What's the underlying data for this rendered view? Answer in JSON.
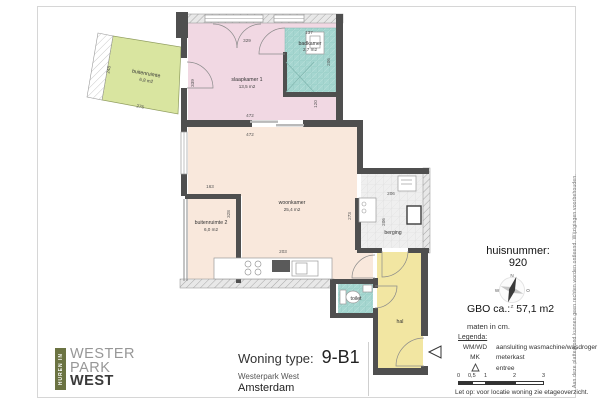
{
  "colors": {
    "wall": "#4f4f4f",
    "exterior_wall": "#e8e8e8",
    "slaapkamer_pink": "#f1d8e3",
    "woonkamer_cream": "#f9e8dc",
    "buitenruimte_green": "#d9e5a0",
    "sanitair_teal": "#a5d6d0",
    "hal_yellow": "#f2e6a2",
    "berging_gray": "#efefef",
    "logo_green": "#6b7342"
  },
  "logo": {
    "tagline": "HUREN IN",
    "line1": "WESTER",
    "line2": "PARK",
    "line3": "WEST"
  },
  "title_block": {
    "label": "Woning type:",
    "value": "9-B1",
    "project": "Westerpark West",
    "city": "Amsterdam"
  },
  "info": {
    "huisnummer_label": "huisnummer:",
    "huisnummer": "920",
    "gbo_label": "GBO ca.:",
    "gbo_value": "57,1 m2",
    "units_note": "maten in cm.",
    "warning_note": "Let op:  voor locatie woning zie etageoverzicht.",
    "disclaimer": "Aan deze plattegrond kunnen geen rechten worden ontleend. Wijzigingen voorbehouden."
  },
  "compass": {
    "north": "N",
    "east": "O",
    "south": "Z",
    "west": "W"
  },
  "legend": {
    "heading": "Legenda:",
    "items": [
      {
        "key": "WM/WD",
        "value": "aansluiting wasmachine/wasdroger"
      },
      {
        "key": "MK",
        "value": "meterkast"
      },
      {
        "key": "",
        "value": "entree"
      }
    ],
    "scale_ticks": [
      "0",
      "0,5",
      "1",
      "2",
      "3"
    ]
  },
  "rooms": [
    {
      "name": "buitenruimte",
      "area": "6,8 m2"
    },
    {
      "name": "slaapkamer 1",
      "area": "13,5 m2"
    },
    {
      "name": "badkamer",
      "area": "2,7 m2"
    },
    {
      "name": "woonkamer",
      "area": "25,4 m2"
    },
    {
      "name": "buitenruimte 2",
      "area": "6,0 m2"
    },
    {
      "name": "berging",
      "area": ""
    },
    {
      "name": "toilet",
      "area": ""
    },
    {
      "name": "hal",
      "area": ""
    }
  ],
  "dimensions": {
    "slaapkamer_width": "329",
    "badkamer_width": "137",
    "badkamer_depth": "206",
    "slaapkamer_depth": "339",
    "strip_width": "120",
    "wall_top": "472",
    "wall_bottom": "472",
    "balkon_depth": "248",
    "balkon_width": "276",
    "buitenruimte2_width": "163",
    "woonkamer_left": "328",
    "kitchen_width": "203",
    "woonkamer_right": "273",
    "berging_width": "206",
    "berging_depth": "206"
  }
}
